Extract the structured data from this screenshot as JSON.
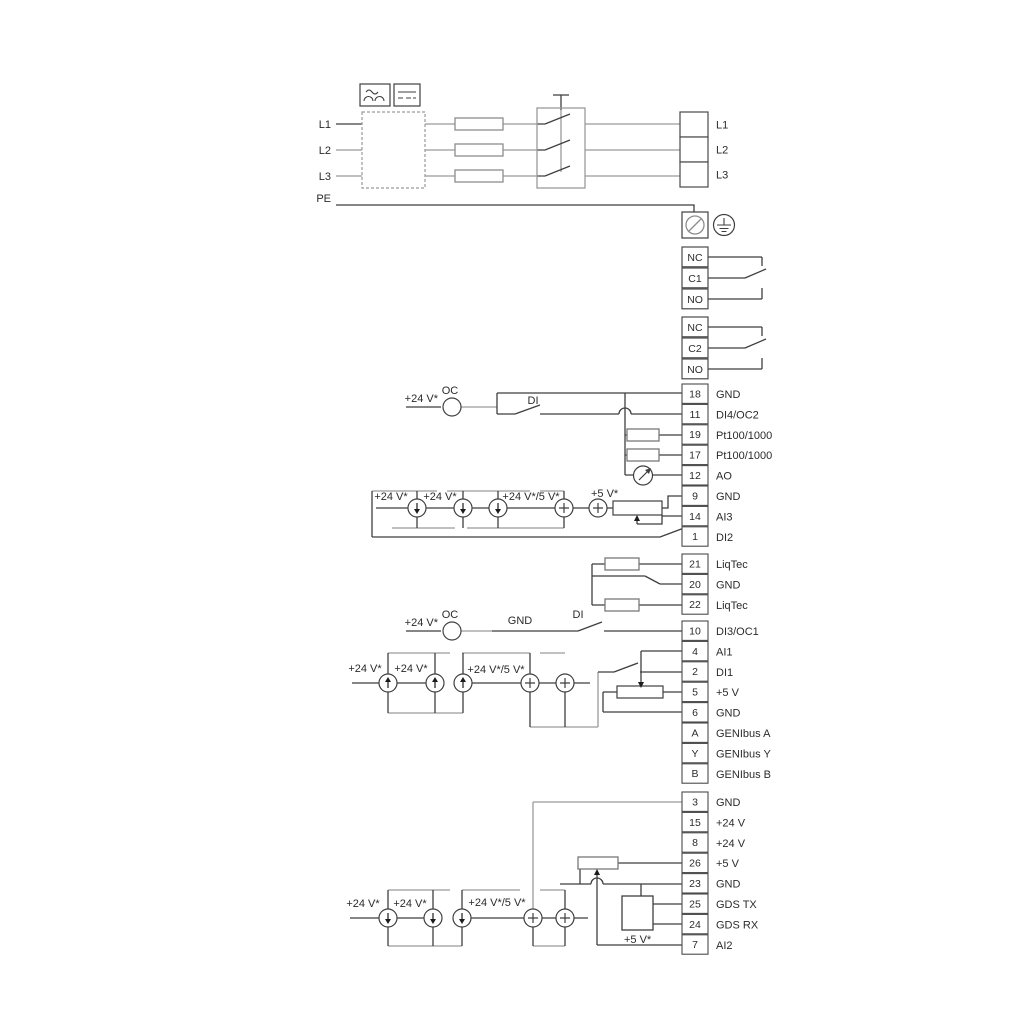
{
  "power_in": [
    "L1",
    "L2",
    "L3",
    "PE"
  ],
  "power_out": {
    "items": [
      "L1",
      "L2",
      "L3"
    ]
  },
  "relays": [
    {
      "items": [
        "NC",
        "C1",
        "NO"
      ]
    },
    {
      "items": [
        "NC",
        "C2",
        "NO"
      ]
    }
  ],
  "terminal_groups": [
    {
      "name": "io1",
      "terminals": [
        [
          "18",
          "GND"
        ],
        [
          "11",
          "DI4/OC2"
        ],
        [
          "19",
          "Pt100/1000"
        ],
        [
          "17",
          "Pt100/1000"
        ],
        [
          "12",
          "AO"
        ],
        [
          "9",
          "GND"
        ],
        [
          "14",
          "AI3"
        ],
        [
          "1",
          "DI2"
        ]
      ]
    },
    {
      "name": "liqtec",
      "terminals": [
        [
          "21",
          "LiqTec"
        ],
        [
          "20",
          "GND"
        ],
        [
          "22",
          "LiqTec"
        ]
      ]
    },
    {
      "name": "io2",
      "terminals": [
        [
          "10",
          "DI3/OC1"
        ],
        [
          "4",
          "AI1"
        ],
        [
          "2",
          "DI1"
        ],
        [
          "5",
          "+5 V"
        ],
        [
          "6",
          "GND"
        ],
        [
          "A",
          "GENIbus A"
        ],
        [
          "Y",
          "GENIbus Y"
        ],
        [
          "B",
          "GENIbus B"
        ]
      ]
    },
    {
      "name": "io3",
      "terminals": [
        [
          "3",
          "GND"
        ],
        [
          "15",
          "+24 V"
        ],
        [
          "8",
          "+24 V"
        ],
        [
          "26",
          "+5 V"
        ],
        [
          "23",
          "GND"
        ],
        [
          "25",
          "GDS TX"
        ],
        [
          "24",
          "GDS RX"
        ],
        [
          "7",
          "AI2"
        ]
      ]
    }
  ],
  "labels": {
    "v24": "+24 V*",
    "v24_5": "+24 V*/5 V*",
    "v5": "+5 V*",
    "oc": "OC",
    "di": "DI",
    "gnd": "GND"
  },
  "colors": {
    "wire_grey": "#9a9a9a",
    "wire_dark": "#3f3f3f",
    "text": "#2b2b2b"
  }
}
